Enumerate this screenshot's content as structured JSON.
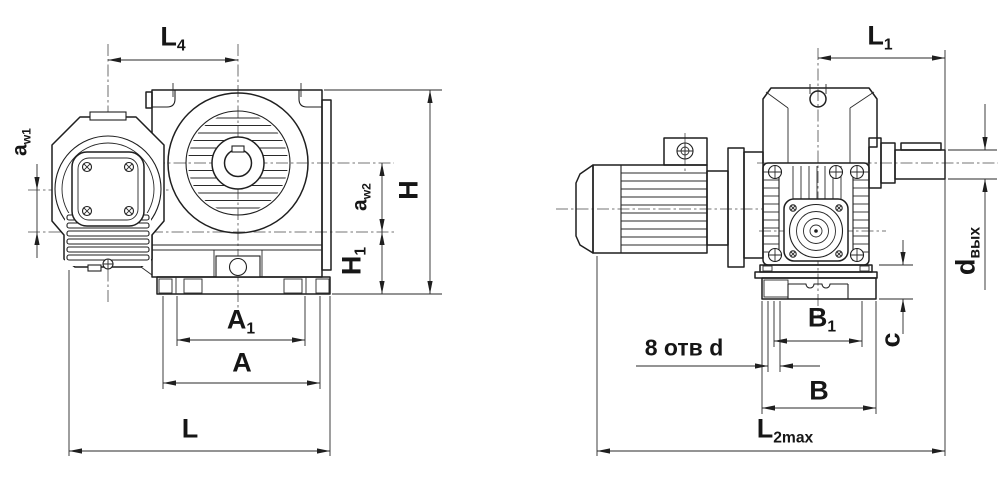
{
  "drawing": {
    "background": "#ffffff",
    "line_color": "#1f1f1f",
    "kind": "gearmotor-dimension-drawing"
  },
  "front_view": {
    "name": "front-view",
    "dims": {
      "l4": {
        "main": "L",
        "sub": "4"
      },
      "aw1": {
        "main": "a",
        "sub": "w1"
      },
      "aw2": {
        "main": "a",
        "sub": "w2"
      },
      "h": {
        "main": "H",
        "sub": ""
      },
      "h1": {
        "main": "H",
        "sub": "1"
      },
      "a1": {
        "main": "A",
        "sub": "1"
      },
      "a": {
        "main": "A",
        "sub": ""
      },
      "l": {
        "main": "L",
        "sub": ""
      }
    }
  },
  "side_view": {
    "name": "side-view",
    "dims": {
      "l1": {
        "main": "L",
        "sub": "1"
      },
      "d_vyh": {
        "main": "d",
        "sub": "вых"
      },
      "c": {
        "main": "c",
        "sub": ""
      },
      "b1": {
        "main": "B",
        "sub": "1"
      },
      "b": {
        "main": "B",
        "sub": ""
      },
      "l2max": {
        "main": "L",
        "sub": "2max"
      },
      "holes": {
        "label": "8 отв d"
      }
    }
  }
}
